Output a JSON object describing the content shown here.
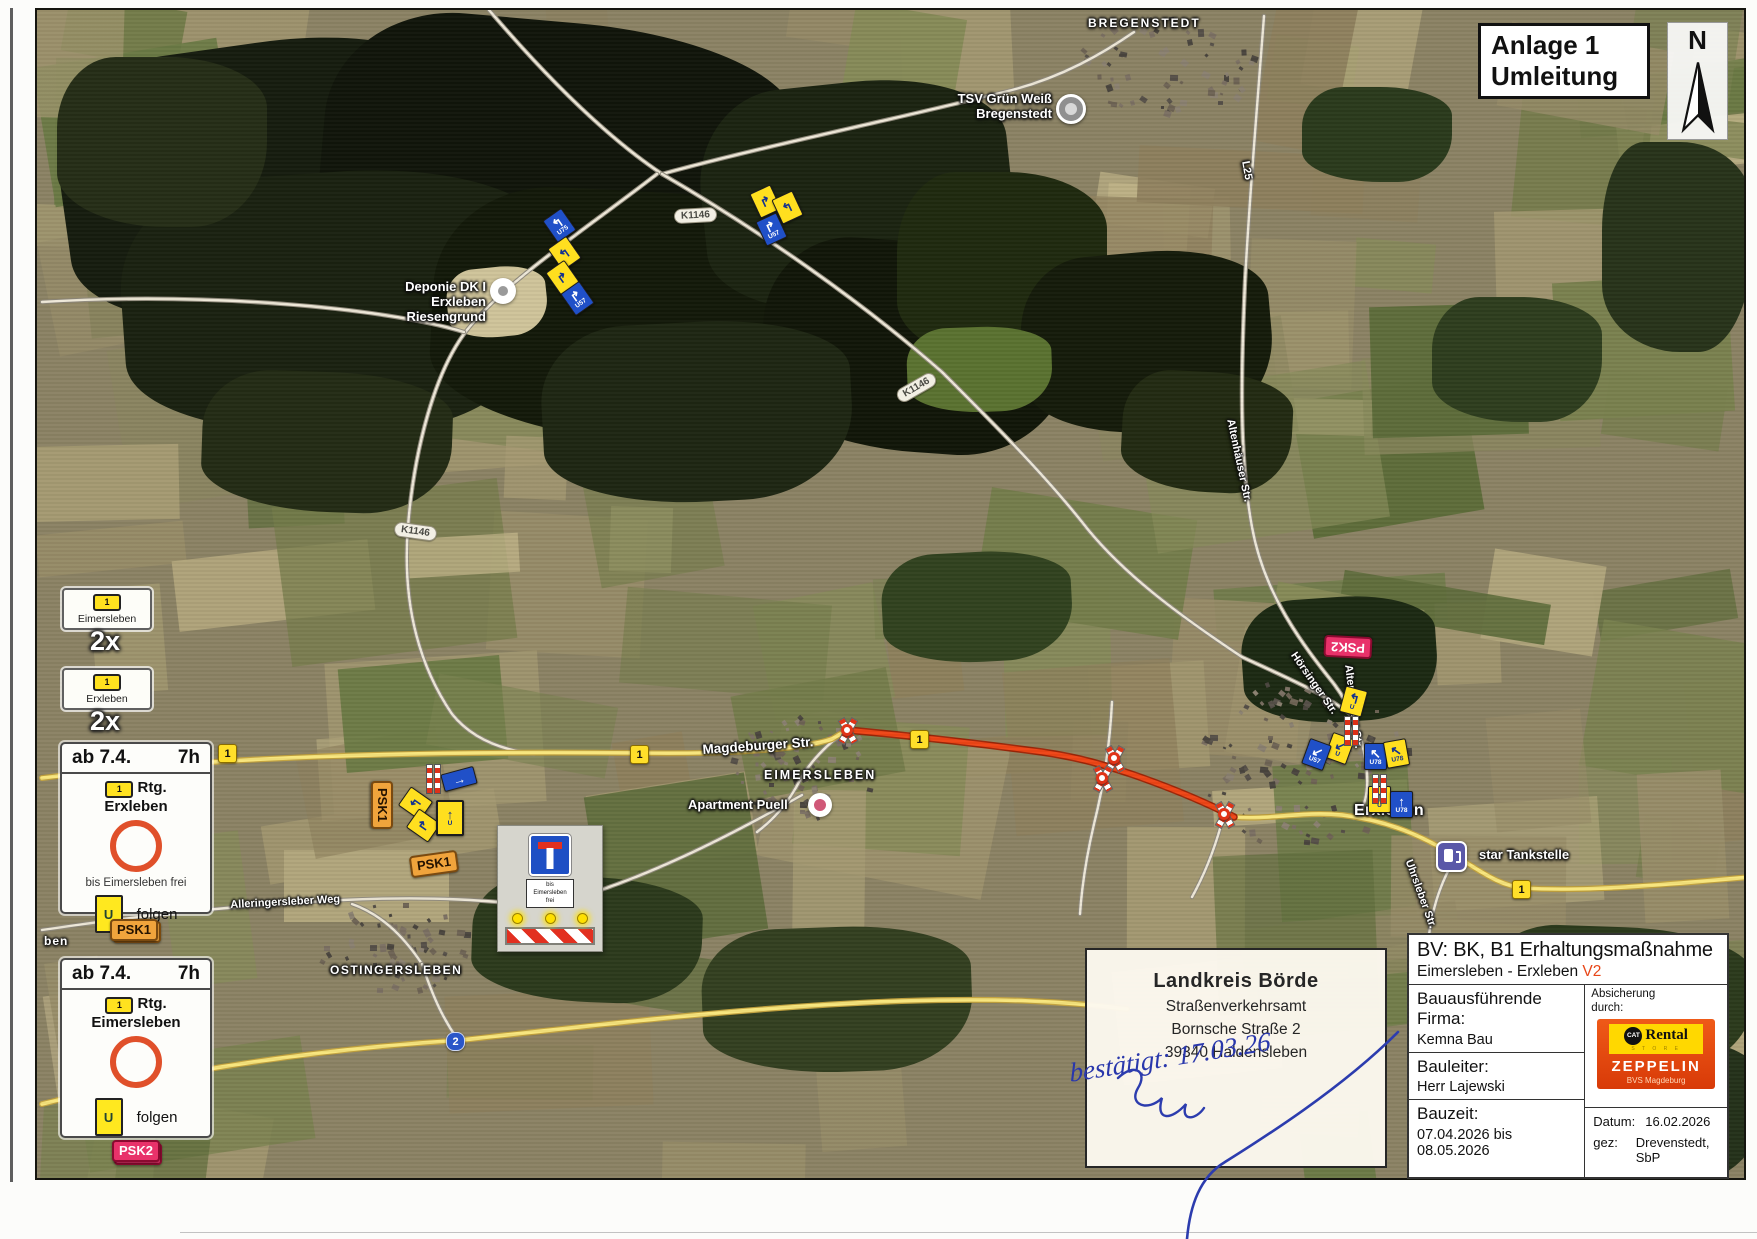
{
  "title_box": {
    "line1": "Anlage 1",
    "line2": "Umleitung"
  },
  "compass": {
    "label": "N"
  },
  "legend": {
    "sign1": {
      "route": "1",
      "town": "Eimersleben",
      "count": "2x"
    },
    "sign2": {
      "route": "1",
      "town": "Erxleben",
      "count": "2x"
    },
    "box1": {
      "from": "ab 7.4.",
      "time": "7h",
      "route": "1",
      "rtg": "Rtg.",
      "dest": "Erxleben",
      "note": "bis Eimersleben frei",
      "u": "U",
      "folgen": "folgen",
      "badge": "PSK1"
    },
    "box2": {
      "from": "ab 7.4.",
      "time": "7h",
      "route": "1",
      "rtg": "Rtg.",
      "dest": "Eimersleben",
      "u": "U",
      "folgen": "folgen",
      "badge": "PSK2"
    }
  },
  "closure_sign": {
    "l1": "bis",
    "l2": "Eimersleben",
    "l3": "frei"
  },
  "stamp": {
    "l1": "Landkreis Börde",
    "l2": "Straßenverkehrsamt",
    "l3": "Bornsche Straße 2",
    "l4": "39340  Haldensleben",
    "hand": "bestätigt: 17.03.26"
  },
  "info": {
    "title": "BV: BK, B1 Erhaltungsmaßnahme",
    "subtitle": "Eimersleben - Erxleben",
    "version": "V2",
    "firma_label": "Bauausführende\nFirma:",
    "firma": "Kemna Bau",
    "bauleiter_label": "Bauleiter:",
    "bauleiter": "Herr Lajewski",
    "bauzeit_label": "Bauzeit:",
    "bauzeit": "07.04.2026 bis\n08.05.2026",
    "absicherung": "Absicherung\ndurch:",
    "cat": "CAT",
    "rental": "Rental",
    "store": "S T O R E",
    "zeppelin": "ZEPPELIN",
    "zeppelin_sub": "BVS Magdeburg",
    "datum_label": "Datum:",
    "datum": "16.02.2026",
    "gez_label": "gez:",
    "gez": "Drevenstedt, SbP"
  },
  "map": {
    "palette": [
      "#978c68",
      "#a59a72",
      "#8a855e",
      "#79814f",
      "#697943",
      "#b1a67c",
      "#868a58",
      "#5d6c3a",
      "#a0956e",
      "#8d7f5c",
      "#c0b488",
      "#747c4a"
    ],
    "house_colors": [
      "#6e6354",
      "#7b7062",
      "#565048",
      "#8a8070",
      "#4a453e"
    ],
    "forest": [
      {
        "x": 60,
        "y": 40,
        "w": 420,
        "h": 280,
        "c": "#161c0e",
        "r": -8
      },
      {
        "x": 320,
        "y": 20,
        "w": 470,
        "h": 270,
        "c": "#10150a",
        "r": 5
      },
      {
        "x": 120,
        "y": 170,
        "w": 430,
        "h": 260,
        "c": "#1a2110",
        "r": -4
      },
      {
        "x": 430,
        "y": 190,
        "w": 430,
        "h": 250,
        "c": "#131909",
        "r": 3
      },
      {
        "x": 700,
        "y": 80,
        "w": 310,
        "h": 230,
        "c": "#1b2311",
        "r": -6
      },
      {
        "x": 760,
        "y": 240,
        "w": 310,
        "h": 210,
        "c": "#111608",
        "r": 4
      },
      {
        "x": 540,
        "y": 320,
        "w": 310,
        "h": 180,
        "c": "#1e2613",
        "r": -3
      },
      {
        "x": 200,
        "y": 370,
        "w": 250,
        "h": 140,
        "c": "#232b15",
        "r": 2
      },
      {
        "x": 895,
        "y": 170,
        "w": 210,
        "h": 190,
        "c": "#1f290f",
        "r": 0
      },
      {
        "x": 1020,
        "y": 250,
        "w": 250,
        "h": 180,
        "c": "#151b0a",
        "r": -5
      },
      {
        "x": 1120,
        "y": 370,
        "w": 170,
        "h": 120,
        "c": "#222a12",
        "r": 3
      },
      {
        "x": 55,
        "y": 55,
        "w": 210,
        "h": 170,
        "c": "#252d17",
        "r": 0
      },
      {
        "x": 1240,
        "y": 595,
        "w": 195,
        "h": 125,
        "c": "#1c2913",
        "r": -4
      },
      {
        "x": 1300,
        "y": 85,
        "w": 150,
        "h": 95,
        "c": "#2a3a1c",
        "r": 0
      },
      {
        "x": 880,
        "y": 550,
        "w": 190,
        "h": 110,
        "c": "#31421f",
        "r": -3
      },
      {
        "x": 470,
        "y": 875,
        "w": 230,
        "h": 125,
        "c": "#2c3a1c",
        "r": 2
      },
      {
        "x": 700,
        "y": 925,
        "w": 270,
        "h": 145,
        "c": "#333f20",
        "r": -2
      },
      {
        "x": 1430,
        "y": 295,
        "w": 170,
        "h": 125,
        "c": "#2e3d1e",
        "r": 0
      },
      {
        "x": 1600,
        "y": 140,
        "w": 150,
        "h": 210,
        "c": "#27331a",
        "r": 0
      },
      {
        "x": 905,
        "y": 325,
        "w": 145,
        "h": 85,
        "c": "#5a7230",
        "r": -2
      },
      {
        "x": 1480,
        "y": 925,
        "w": 270,
        "h": 145,
        "c": "#2b3a1c",
        "r": 2
      },
      {
        "x": 1560,
        "y": 1035,
        "w": 200,
        "h": 145,
        "c": "#24311a",
        "r": 0
      },
      {
        "x": 445,
        "y": 265,
        "w": 100,
        "h": 70,
        "c": "#cfc49a",
        "r": -6
      }
    ],
    "villages": [
      {
        "cx": 800,
        "cy": 765,
        "rx": 72,
        "ry": 52,
        "n": 70
      },
      {
        "cx": 1300,
        "cy": 760,
        "rx": 105,
        "ry": 85,
        "n": 110
      },
      {
        "cx": 390,
        "cy": 945,
        "rx": 78,
        "ry": 45,
        "n": 60
      },
      {
        "cx": 1165,
        "cy": 62,
        "rx": 95,
        "ry": 48,
        "n": 65
      }
    ],
    "roads": [
      {
        "t": "w",
        "d": "M487,8 C540,70 600,132 660,172"
      },
      {
        "t": "w",
        "d": "M660,172 C770,142 900,116 1010,88 C1060,75 1100,52 1132,30"
      },
      {
        "t": "w",
        "d": "M660,172 C760,230 860,300 940,370 C990,420 1040,470 1080,520 C1120,572 1180,615 1240,655 C1290,678 1330,695 1355,718"
      },
      {
        "t": "w",
        "d": "M655,172 C580,230 505,278 465,328 C432,370 412,450 406,524 C400,600 416,662 450,712 C470,737 500,748 532,752"
      },
      {
        "t": "w",
        "d": "M462,330 C380,305 200,290 40,300"
      },
      {
        "t": "w",
        "d": "M1262,14 C1254,120 1247,200 1243,280 C1239,370 1237,455 1250,525 C1262,592 1300,642 1332,682 C1350,706 1360,732 1364,762 C1368,792 1362,808 1352,816"
      },
      {
        "t": "w",
        "d": "M1110,700 C1108,740 1102,782 1092,822 C1085,852 1080,882 1078,912"
      },
      {
        "t": "w",
        "d": "M40,928 C140,913 240,903 340,898 C430,894 490,898 540,905"
      },
      {
        "t": "w",
        "d": "M800,793 C720,838 640,878 560,900"
      },
      {
        "t": "w",
        "d": "M845,728 C825,742 808,760 798,778 C788,798 775,815 755,830"
      },
      {
        "t": "w",
        "d": "M420,962 C400,932 378,912 350,902"
      },
      {
        "t": "w",
        "d": "M420,962 C432,998 442,1018 456,1038"
      },
      {
        "t": "w",
        "d": "M1452,858 C1438,882 1428,912 1426,944"
      },
      {
        "t": "w",
        "d": "M1222,812 C1215,840 1205,868 1190,895"
      },
      {
        "t": "y",
        "d": "M40,776 C150,762 320,748 636,751 C700,752 792,750 830,737 L845,728"
      },
      {
        "t": "y",
        "d": "M1232,815 C1268,818 1300,809 1340,813 C1388,819 1420,834 1455,855 C1480,870 1498,884 1522,886 C1580,890 1660,883 1748,875"
      },
      {
        "t": "y",
        "d": "M40,1102 C160,1072 300,1048 460,1038 C620,1020 760,1004 900,999 C1000,996 1060,999 1125,1007"
      },
      {
        "t": "r",
        "d": "M845,728 C900,733 980,742 1040,750 C1080,756 1102,763 1132,773 C1172,787 1205,801 1232,815"
      }
    ],
    "towns": [
      {
        "t": "BREGENSTEDT",
        "x": 1086,
        "y": 15,
        "fs": 12,
        "ls": 2
      },
      {
        "t": "EIMERSLEBEN",
        "x": 762,
        "y": 766,
        "fs": 12.5,
        "ls": 2
      },
      {
        "t": "OSTINGERSLEBEN",
        "x": 328,
        "y": 962,
        "fs": 12,
        "ls": 1.5
      },
      {
        "t": "Erxleben",
        "x": 1352,
        "y": 800,
        "fs": 16,
        "ls": 0.3
      },
      {
        "t": "ben",
        "x": 42,
        "y": 933,
        "fs": 12,
        "ls": 1
      }
    ],
    "streets": [
      {
        "t": "Magdeburger Str.",
        "x": 700,
        "y": 740,
        "r": -4,
        "fs": 13.5
      },
      {
        "t": "Alleringersleber Weg",
        "x": 228,
        "y": 897,
        "r": -3,
        "fs": 11
      },
      {
        "t": "Hörsinger Str.",
        "x": 1296,
        "y": 648,
        "r": 55,
        "fs": 11
      },
      {
        "t": "Altenhäuser Str.",
        "x": 1352,
        "y": 662,
        "r": 83,
        "fs": 11
      },
      {
        "t": "Altenhäuser Str.",
        "x": 1234,
        "y": 416,
        "r": 78,
        "fs": 11
      },
      {
        "t": "L25",
        "x": 1249,
        "y": 158,
        "r": 80,
        "fs": 11
      },
      {
        "t": "Uhrsleber Str.",
        "x": 1412,
        "y": 856,
        "r": 70,
        "fs": 11
      }
    ],
    "pills": [
      {
        "t": "K1146",
        "x": 672,
        "y": 206,
        "r": -3
      },
      {
        "t": "K1146",
        "x": 893,
        "y": 378,
        "r": -30
      },
      {
        "t": "K1146",
        "x": 392,
        "y": 522,
        "r": 8
      }
    ],
    "shields": [
      {
        "t": "1",
        "x": 216,
        "y": 742,
        "c": "y"
      },
      {
        "t": "1",
        "x": 628,
        "y": 743,
        "c": "y"
      },
      {
        "t": "1",
        "x": 908,
        "y": 728,
        "c": "y"
      },
      {
        "t": "1",
        "x": 1510,
        "y": 878,
        "c": "y"
      },
      {
        "t": "2",
        "x": 444,
        "y": 1030,
        "c": "b"
      }
    ],
    "badges": [
      {
        "t": "PSK1",
        "x": 356,
        "y": 792,
        "r": 90,
        "c": "o"
      },
      {
        "t": "PSK1",
        "x": 408,
        "y": 851,
        "r": -8,
        "c": "o"
      },
      {
        "t": "PSK1",
        "x": 111,
        "y": 919,
        "r": 0,
        "c": "o"
      },
      {
        "t": "PSK2",
        "x": 1322,
        "y": 634,
        "r": 183,
        "c": "p"
      },
      {
        "t": "PSK2",
        "x": 112,
        "y": 1141,
        "r": 0,
        "c": "p"
      }
    ],
    "signs": [
      {
        "x": 546,
        "y": 210,
        "r": -35,
        "c": "b",
        "g": "↰",
        "l": "U75"
      },
      {
        "x": 551,
        "y": 238,
        "r": -35,
        "c": "y",
        "g": "↰",
        "l": ""
      },
      {
        "x": 549,
        "y": 262,
        "r": -35,
        "c": "y",
        "g": "↱",
        "l": ""
      },
      {
        "x": 564,
        "y": 283,
        "r": -35,
        "c": "b",
        "g": "↱",
        "l": "U57"
      },
      {
        "x": 752,
        "y": 186,
        "r": -25,
        "c": "y",
        "g": "↱",
        "l": ""
      },
      {
        "x": 774,
        "y": 192,
        "r": -25,
        "c": "y",
        "g": "↰",
        "l": ""
      },
      {
        "x": 758,
        "y": 214,
        "r": -25,
        "c": "b",
        "g": "↱",
        "l": "U57"
      },
      {
        "x": 440,
        "y": 768,
        "r": -15,
        "c": "bar",
        "g": "→",
        "l": ""
      },
      {
        "x": 402,
        "y": 788,
        "r": -55,
        "c": "y",
        "g": "↰",
        "l": ""
      },
      {
        "x": 410,
        "y": 810,
        "r": -55,
        "c": "y",
        "g": "↱",
        "l": ""
      },
      {
        "x": 434,
        "y": 798,
        "r": 0,
        "c": "yu",
        "g": "↑",
        "l": "U"
      },
      {
        "x": 1340,
        "y": 686,
        "r": 15,
        "c": "y",
        "g": "↰",
        "l": "U"
      },
      {
        "x": 1326,
        "y": 733,
        "r": 20,
        "c": "y",
        "g": "↙",
        "l": "U"
      },
      {
        "x": 1303,
        "y": 739,
        "r": 20,
        "c": "b",
        "g": "↙",
        "l": "U57"
      },
      {
        "x": 1362,
        "y": 741,
        "r": 0,
        "c": "b",
        "g": "↖",
        "l": "U78"
      },
      {
        "x": 1383,
        "y": 738,
        "r": -10,
        "c": "y",
        "g": "↖",
        "l": "U78"
      },
      {
        "x": 1366,
        "y": 784,
        "r": 0,
        "c": "y",
        "g": "↑",
        "l": "U"
      },
      {
        "x": 1388,
        "y": 789,
        "r": 0,
        "c": "b",
        "g": "↑",
        "l": "U78"
      }
    ],
    "poles": [
      {
        "x": 424,
        "y": 762
      },
      {
        "x": 1342,
        "y": 714
      },
      {
        "x": 1370,
        "y": 772
      }
    ],
    "crossings": [
      {
        "x": 845,
        "y": 728
      },
      {
        "x": 1112,
        "y": 756
      },
      {
        "x": 1100,
        "y": 776
      },
      {
        "x": 1222,
        "y": 812
      }
    ],
    "pois": [
      {
        "t": "TSV Grün Weiß\nBregenstedt",
        "x": 930,
        "y": 90,
        "w": 120,
        "al": "right",
        "m": "sport",
        "mx": 1054,
        "my": 92
      },
      {
        "t": "Deponie DK I\nErxleben Riesengrund",
        "x": 360,
        "y": 278,
        "w": 124,
        "al": "right",
        "m": "dep",
        "mx": 488,
        "my": 276
      },
      {
        "t": "Apartment Puell",
        "x": 686,
        "y": 796,
        "w": 115,
        "al": "left",
        "m": "apt",
        "mx": 806,
        "my": 791
      },
      {
        "t": "star Tankstelle",
        "x": 1477,
        "y": 846,
        "w": 120,
        "al": "left",
        "m": "fuel",
        "mx": 1434,
        "my": 839
      }
    ]
  }
}
